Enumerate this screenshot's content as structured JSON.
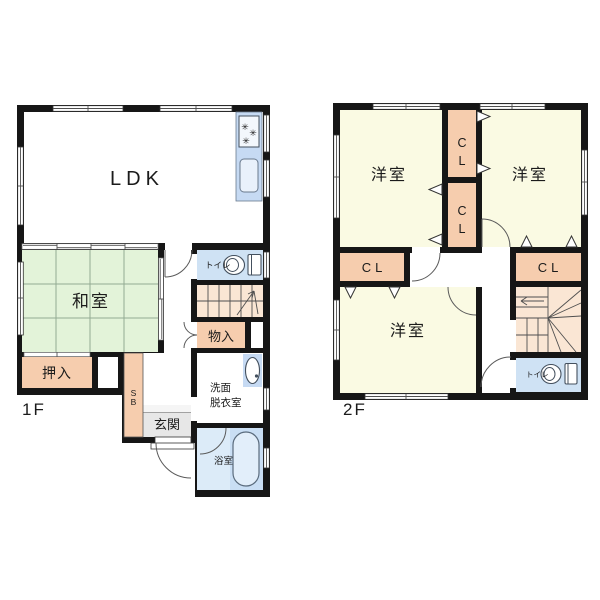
{
  "palette": {
    "wall": "#161616",
    "tatami_green": "#e3f3d9",
    "tatami_grid": "#93ab93",
    "western_room_cream": "#fafae3",
    "closet_peach": "#f6cdae",
    "stairs_peach": "#fae6d4",
    "water_area_blue": "#cfe2f4",
    "kitchen_blue": "#c6daf3",
    "bath_floor_light": "#dcebf8",
    "bath_floor_dark": "#c9def4",
    "genkan_gray": "#e7e7e7"
  },
  "floor1": {
    "floor_label": "1F",
    "ldk": "LDK",
    "washitsu": "和室",
    "oshiire": "押入",
    "storage": "物入",
    "toilet": "トイレ",
    "genkan": "玄関",
    "shoebox_top": "S",
    "shoebox_bottom": "B",
    "washroom_line1": "洗面",
    "washroom_line2": "脱衣室",
    "bathroom": "浴室"
  },
  "floor2": {
    "floor_label": "2F",
    "bedroom_top_left": "洋室",
    "bedroom_top_right": "洋室",
    "bedroom_bottom": "洋室",
    "closet_center_top_c": "C",
    "closet_center_top_l": "L",
    "closet_center_mid_c": "C",
    "closet_center_mid_l": "L",
    "closet_left": "CL",
    "closet_right": "CL",
    "toilet": "トイレ"
  }
}
